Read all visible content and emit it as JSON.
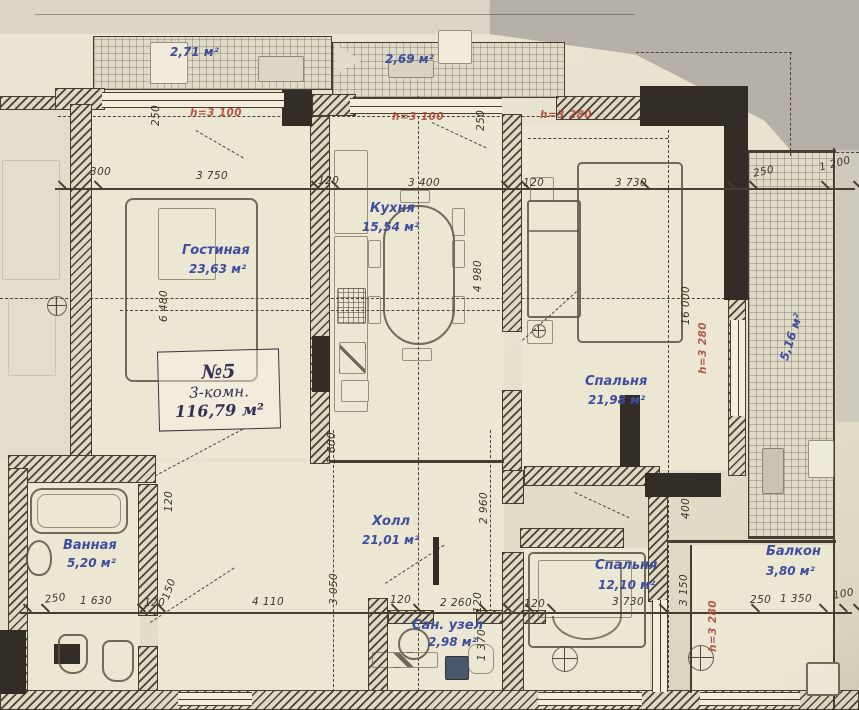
{
  "colors": {
    "paper": "#e8e3d0",
    "ink": "#453e33",
    "room_label_blue": "#3f4e9c",
    "height_note_red": "#ad4a3c",
    "photo_grey": "#b5b1a8",
    "wall_black": "#322d27"
  },
  "apartment": {
    "number": "№5",
    "type": "3-комн.",
    "total_area": "116,79 м²"
  },
  "rooms": [
    {
      "id": "living",
      "name": "Гостиная",
      "area": "23,63 м²",
      "x": 182,
      "y": 243,
      "ax": 189,
      "ay": 262
    },
    {
      "id": "kitchen",
      "name": "Кухня",
      "area": "15,54 м²",
      "x": 370,
      "y": 201,
      "ax": 362,
      "ay": 220
    },
    {
      "id": "bedroom-1",
      "name": "Спальня",
      "area": "21,98 м²",
      "x": 585,
      "y": 374,
      "ax": 588,
      "ay": 393
    },
    {
      "id": "hall",
      "name": "Холл",
      "area": "21,01 м²",
      "x": 372,
      "y": 514,
      "ax": 362,
      "ay": 533
    },
    {
      "id": "bathroom",
      "name": "Ванная",
      "area": "5,20 м²",
      "x": 63,
      "y": 538,
      "ax": 67,
      "ay": 556
    },
    {
      "id": "bedroom-2",
      "name": "Спальня",
      "area": "12,10 м²",
      "x": 595,
      "y": 558,
      "ax": 598,
      "ay": 578
    },
    {
      "id": "wc",
      "name": "Сан. узел",
      "area": "2,98 м²",
      "x": 412,
      "y": 618,
      "ax": 428,
      "ay": 635
    },
    {
      "id": "balcony",
      "name": "Балкон",
      "area": "3,80 м²",
      "x": 766,
      "y": 544,
      "ax": 766,
      "ay": 564
    }
  ],
  "open_areas": [
    {
      "id": "balcony-top-left",
      "t": "2,71 м²",
      "x": 170,
      "y": 45,
      "rot": 0
    },
    {
      "id": "balcony-top-center",
      "t": "2,69 м²",
      "x": 385,
      "y": 52,
      "rot": 0
    },
    {
      "id": "loggia-right",
      "t": "5,16 м²",
      "x": 777,
      "y": 358,
      "rot": -72
    }
  ],
  "height_notes": [
    {
      "t": "h=3 100",
      "x": 190,
      "y": 107,
      "rot": 0
    },
    {
      "t": "h=3 100",
      "x": 392,
      "y": 111,
      "rot": 0
    },
    {
      "t": "h=3 280",
      "x": 540,
      "y": 109,
      "rot": 0
    },
    {
      "t": "h=3 280",
      "x": 697,
      "y": 374,
      "rot": -90
    },
    {
      "t": "h=3 280",
      "x": 707,
      "y": 652,
      "rot": -90
    }
  ],
  "dims_top": [
    {
      "t": "300",
      "x": 90,
      "y": 166,
      "rot": 0
    },
    {
      "t": "3 750",
      "x": 196,
      "y": 170,
      "rot": 0
    },
    {
      "t": "120",
      "x": 318,
      "y": 175,
      "rot": 0
    },
    {
      "t": "3 400",
      "x": 408,
      "y": 177,
      "rot": 0
    },
    {
      "t": "120",
      "x": 523,
      "y": 177,
      "rot": 0
    },
    {
      "t": "3 730",
      "x": 615,
      "y": 177,
      "rot": 0
    },
    {
      "t": "250",
      "x": 752,
      "y": 168,
      "rot": -12
    },
    {
      "t": "1 200",
      "x": 818,
      "y": 162,
      "rot": -14
    }
  ],
  "dims_bottom": [
    {
      "t": "250",
      "x": 44,
      "y": 594,
      "rot": -8
    },
    {
      "t": "1 630",
      "x": 80,
      "y": 595,
      "rot": 0
    },
    {
      "t": "120",
      "x": 144,
      "y": 597,
      "rot": 0
    },
    {
      "t": "4 110",
      "x": 252,
      "y": 596,
      "rot": 0
    },
    {
      "t": "120",
      "x": 390,
      "y": 594,
      "rot": 0
    },
    {
      "t": "2 260",
      "x": 440,
      "y": 597,
      "rot": 0
    },
    {
      "t": "120",
      "x": 472,
      "y": 613,
      "rot": -90
    },
    {
      "t": "120",
      "x": 524,
      "y": 598,
      "rot": 0
    },
    {
      "t": "3 730",
      "x": 612,
      "y": 596,
      "rot": 0
    },
    {
      "t": "250",
      "x": 750,
      "y": 594,
      "rot": 0
    },
    {
      "t": "1 350",
      "x": 780,
      "y": 593,
      "rot": 0
    },
    {
      "t": "100",
      "x": 832,
      "y": 590,
      "rot": -10
    }
  ],
  "dims_vertical": [
    {
      "t": "250",
      "x": 150,
      "y": 126,
      "rot": -90
    },
    {
      "t": "250",
      "x": 475,
      "y": 131,
      "rot": -90
    },
    {
      "t": "6 480",
      "x": 158,
      "y": 322,
      "rot": -90
    },
    {
      "t": "4 980",
      "x": 472,
      "y": 292,
      "rot": -90
    },
    {
      "t": "16 000",
      "x": 680,
      "y": 325,
      "rot": -90
    },
    {
      "t": "1 600",
      "x": 326,
      "y": 464,
      "rot": -90
    },
    {
      "t": "2 960",
      "x": 478,
      "y": 524,
      "rot": -90
    },
    {
      "t": "3 050",
      "x": 328,
      "y": 605,
      "rot": -90
    },
    {
      "t": "1 370",
      "x": 476,
      "y": 661,
      "rot": -90
    },
    {
      "t": "120",
      "x": 163,
      "y": 512,
      "rot": -90
    },
    {
      "t": "150",
      "x": 160,
      "y": 597,
      "rot": -70
    },
    {
      "t": "400",
      "x": 680,
      "y": 519,
      "rot": -90
    },
    {
      "t": "3 150",
      "x": 678,
      "y": 606,
      "rot": -90
    }
  ]
}
